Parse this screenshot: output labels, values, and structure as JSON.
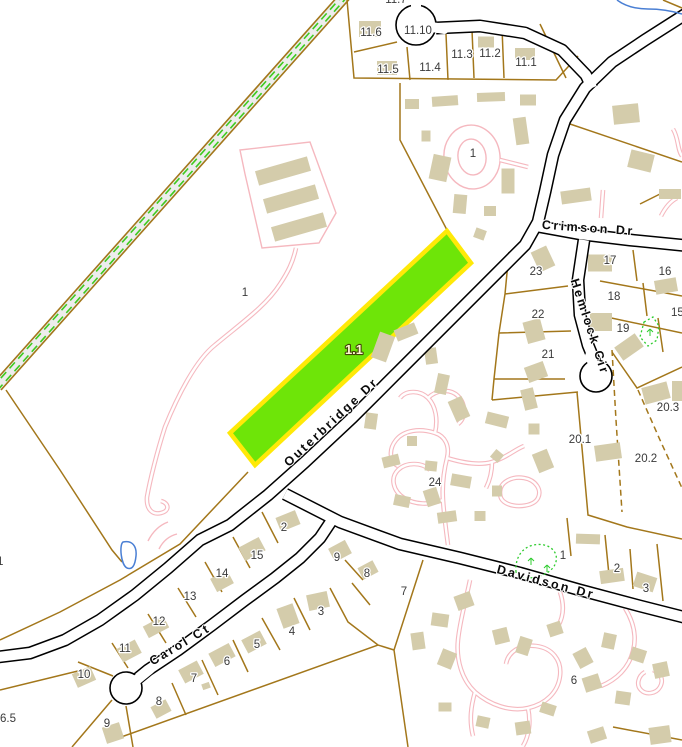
{
  "map": {
    "highlighted_parcel": {
      "label": "1.1",
      "fill": "#6ee508",
      "border": "#ffe908"
    },
    "road_labels": [
      {
        "name": "Crimson Dr"
      },
      {
        "name": "Hemlock Cir"
      },
      {
        "name": "Outerbridge Dr"
      },
      {
        "name": "Davidson Dr"
      },
      {
        "name": "Carol Ct"
      }
    ],
    "parcel_labels": [
      {
        "text": "11.7"
      },
      {
        "text": "11.6"
      },
      {
        "text": "11.10"
      },
      {
        "text": "11.3"
      },
      {
        "text": "11.2"
      },
      {
        "text": "11.1"
      },
      {
        "text": "11.5"
      },
      {
        "text": "11.4"
      },
      {
        "text": "1"
      },
      {
        "text": "1"
      },
      {
        "text": "23"
      },
      {
        "text": "17"
      },
      {
        "text": "16"
      },
      {
        "text": "22"
      },
      {
        "text": "18"
      },
      {
        "text": "19"
      },
      {
        "text": "15"
      },
      {
        "text": "21"
      },
      {
        "text": "20.3"
      },
      {
        "text": "20.1"
      },
      {
        "text": "20.2"
      },
      {
        "text": "24"
      },
      {
        "text": "2"
      },
      {
        "text": "15"
      },
      {
        "text": "9"
      },
      {
        "text": "14"
      },
      {
        "text": "8"
      },
      {
        "text": "13"
      },
      {
        "text": "7"
      },
      {
        "text": "12"
      },
      {
        "text": "11"
      },
      {
        "text": "6"
      },
      {
        "text": "5"
      },
      {
        "text": "4"
      },
      {
        "text": "3"
      },
      {
        "text": "10"
      },
      {
        "text": "7"
      },
      {
        "text": "8"
      },
      {
        "text": "9"
      },
      {
        "text": "1"
      },
      {
        "text": "2"
      },
      {
        "text": "3"
      },
      {
        "text": "6"
      },
      {
        "text": "1"
      },
      {
        "text": "6.5"
      }
    ],
    "colors": {
      "background": "#ffffff",
      "parcel_line": "#a3771b",
      "road_casing": "#000000",
      "road_fill": "#ffffff",
      "building": "#d4ccab",
      "driveway_pink": "#f5b8bf",
      "water_blue": "#4a7fd4",
      "wetland_green": "#2ecc2e",
      "corridor_fill": "#ededed",
      "corridor_dash_green": "#3fca1f",
      "label_text": "#3a3a3a",
      "highlight_fill": "#6ee508",
      "highlight_border": "#ffe908"
    }
  }
}
